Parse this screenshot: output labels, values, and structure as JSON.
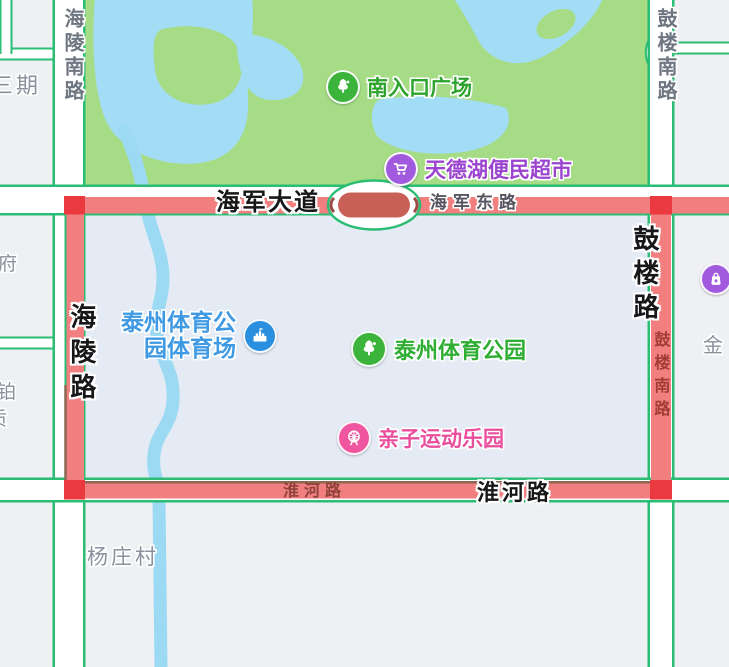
{
  "map": {
    "pois": {
      "south_entrance": {
        "name": "南入口广场",
        "icon": "tree-icon",
        "color": "#3cb43c",
        "text_color": "#2da32d"
      },
      "supermarket": {
        "name": "天德湖便民超市",
        "icon": "shopping-cart-icon",
        "color": "#a159dd",
        "text_color": "#9b44cf"
      },
      "stadium": {
        "name_line1": "泰州体育公",
        "name_line2": "园体育场",
        "icon": "stadium-icon",
        "color": "#2b8fe0",
        "text_color": "#3f9ae3"
      },
      "sports_park": {
        "name": "泰州体育公园",
        "icon": "tree-icon",
        "color": "#3cb43c",
        "text_color": "#2fae33"
      },
      "kids_park": {
        "name": "亲子运动乐园",
        "icon": "ferris-wheel-icon",
        "color": "#f0569f",
        "text_color": "#ea4f9d"
      },
      "mall": {
        "name": "",
        "icon": "shopping-bag-icon",
        "color": "#a159dd"
      }
    },
    "road_labels": {
      "haijun_avenue": "海军大道",
      "haijun_east_road": "海军东路",
      "hailing_road": "海陵路",
      "hailing_south_road": "海陵南路",
      "gulou_road": "鼓楼路",
      "gulou_south_road_top": "鼓楼南路",
      "gulou_south_road_on_route": "鼓楼南路",
      "huaihe_road_on_route": "淮河路",
      "huaihe_road_bold": "淮河路"
    },
    "area_labels": {
      "sanqi": "三期",
      "fu": "府",
      "bo": "铂",
      "zhi": "质",
      "jin": "金",
      "yangzhuangcun": "杨庄村"
    },
    "colors": {
      "route_highlight": "#f17f7f",
      "route_node": "#ea3a40",
      "route_inner_dark": "#c96057",
      "road_casing_green": "#2bbd74",
      "park_green": "#a6dc86",
      "water_blue": "#a3dcf5",
      "inside_fill": "#e4ebf5",
      "block_gray": "#eef0f3",
      "boundary_brown": "#8a6950"
    }
  }
}
